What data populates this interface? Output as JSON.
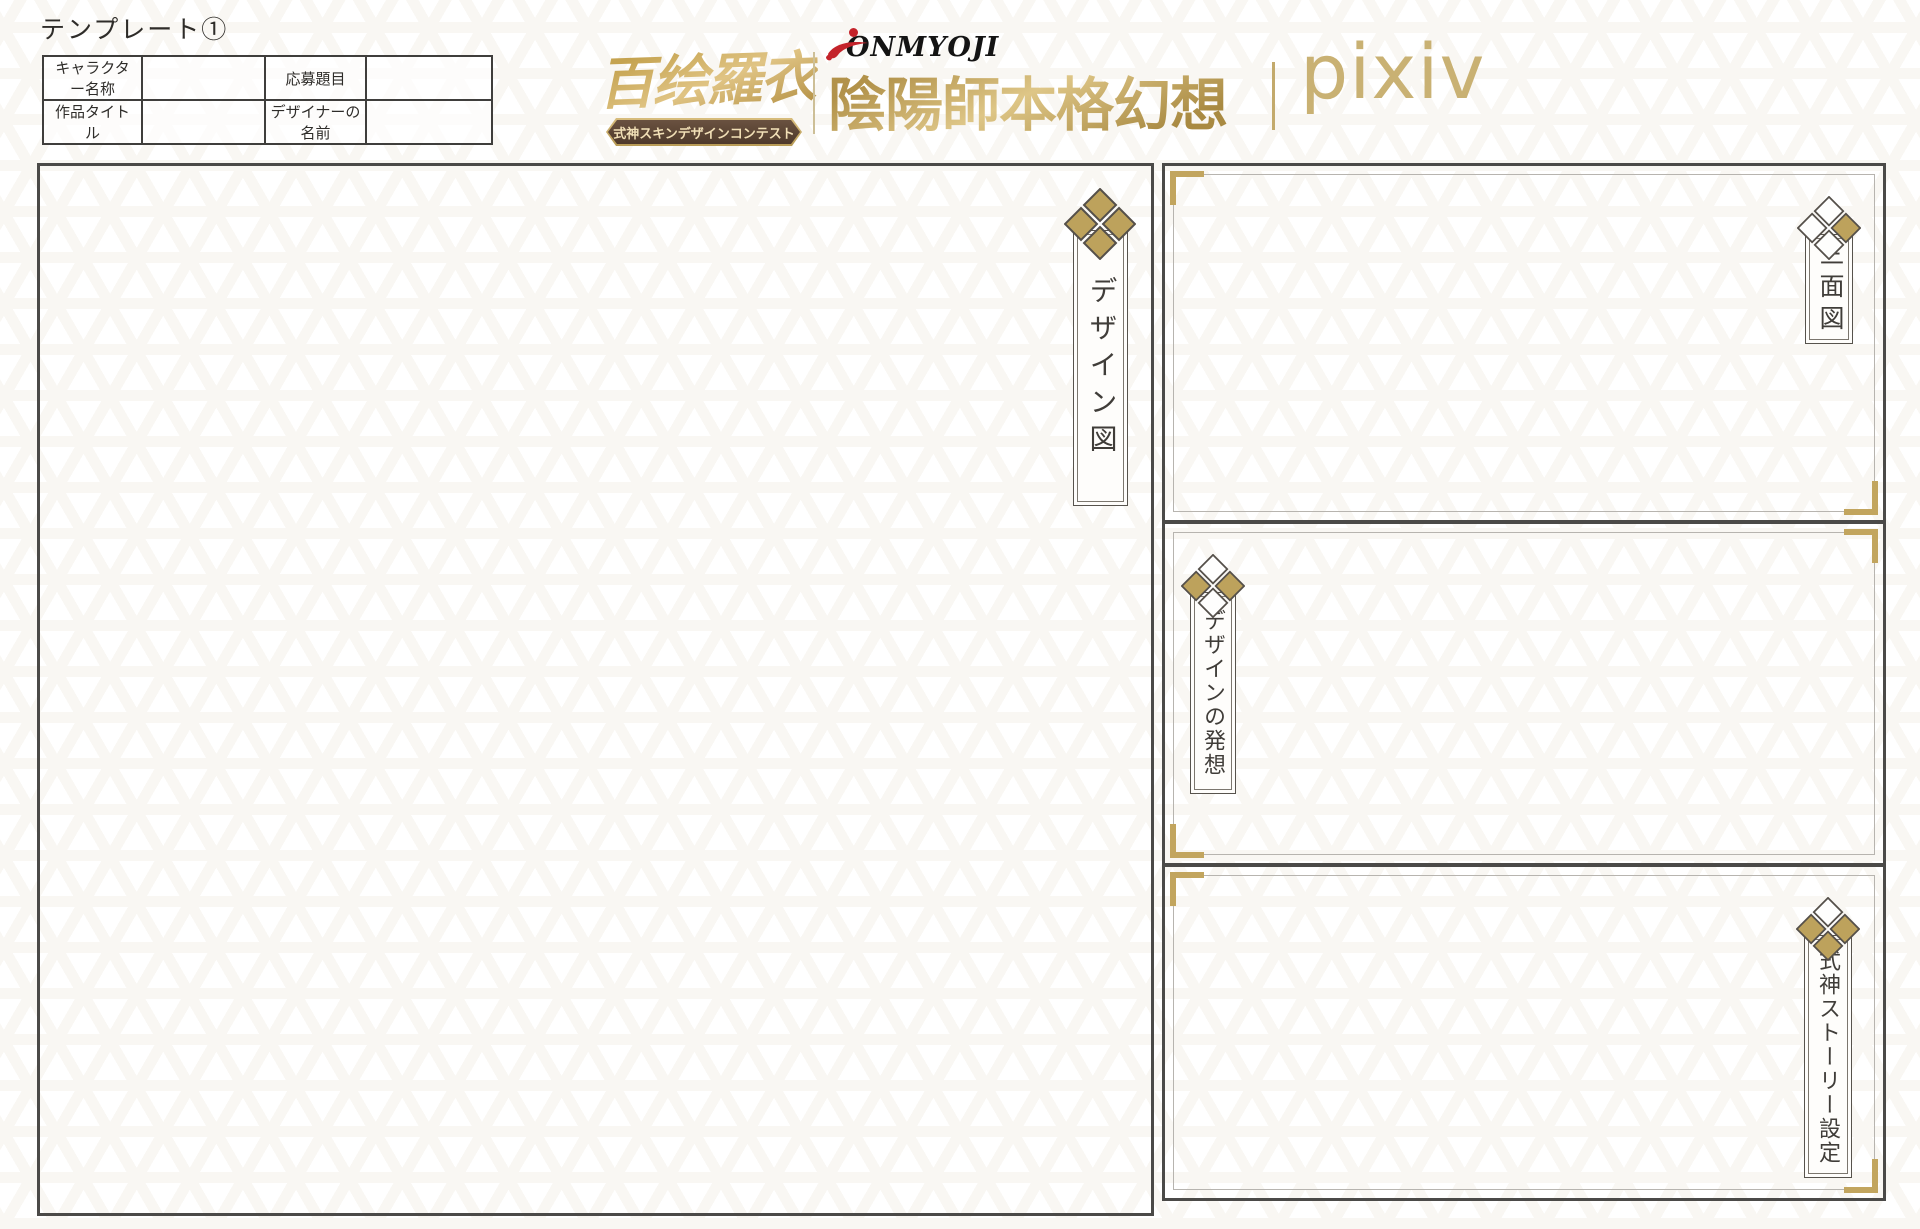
{
  "page": {
    "template_label": "テンプレート①"
  },
  "info_table": {
    "rows": [
      {
        "c1": "キャラクター名称",
        "c2": "",
        "c3": "応募題目",
        "c4": ""
      },
      {
        "c1": "作品タイトル",
        "c2": "",
        "c3": "デザイナーの名前",
        "c4": ""
      }
    ]
  },
  "logos": {
    "contest": {
      "title": "百绘羅衣",
      "banner": "式神スキンデザインコンテスト",
      "banner_ornament": "✿"
    },
    "onmyoji": {
      "wordmark": "ONMYOJI",
      "title": "陰陽師本格幻想",
      "suffix": "RPG"
    },
    "pixiv": {
      "wordmark": "pixiv"
    }
  },
  "sections": {
    "design": {
      "label": "デザイン図",
      "diamonds": [
        "gold",
        "gold",
        "gold",
        "gold"
      ]
    },
    "three": {
      "label": "三面図",
      "diamonds": [
        "white",
        "white",
        "gold",
        "white"
      ]
    },
    "concept": {
      "label": "デザインの発想",
      "diamonds": [
        "white",
        "gold",
        "gold",
        "white"
      ]
    },
    "story": {
      "label": "式神ストーリー設定",
      "diamonds": [
        "white",
        "gold",
        "gold",
        "gold"
      ]
    }
  },
  "colors": {
    "gold_accent": "#c2a55e",
    "diamond_gold": "#bda25c",
    "diamond_white": "#fefefd",
    "diamond_stroke": "#55504a",
    "border_dark": "#4b4a48",
    "inner_line_gray": "#b7b4af",
    "ribbon_brown": "#5a4434",
    "logo_gold": "#c9b173",
    "logo_red": "#c4232a",
    "pattern_beige": "#f3ede3"
  }
}
